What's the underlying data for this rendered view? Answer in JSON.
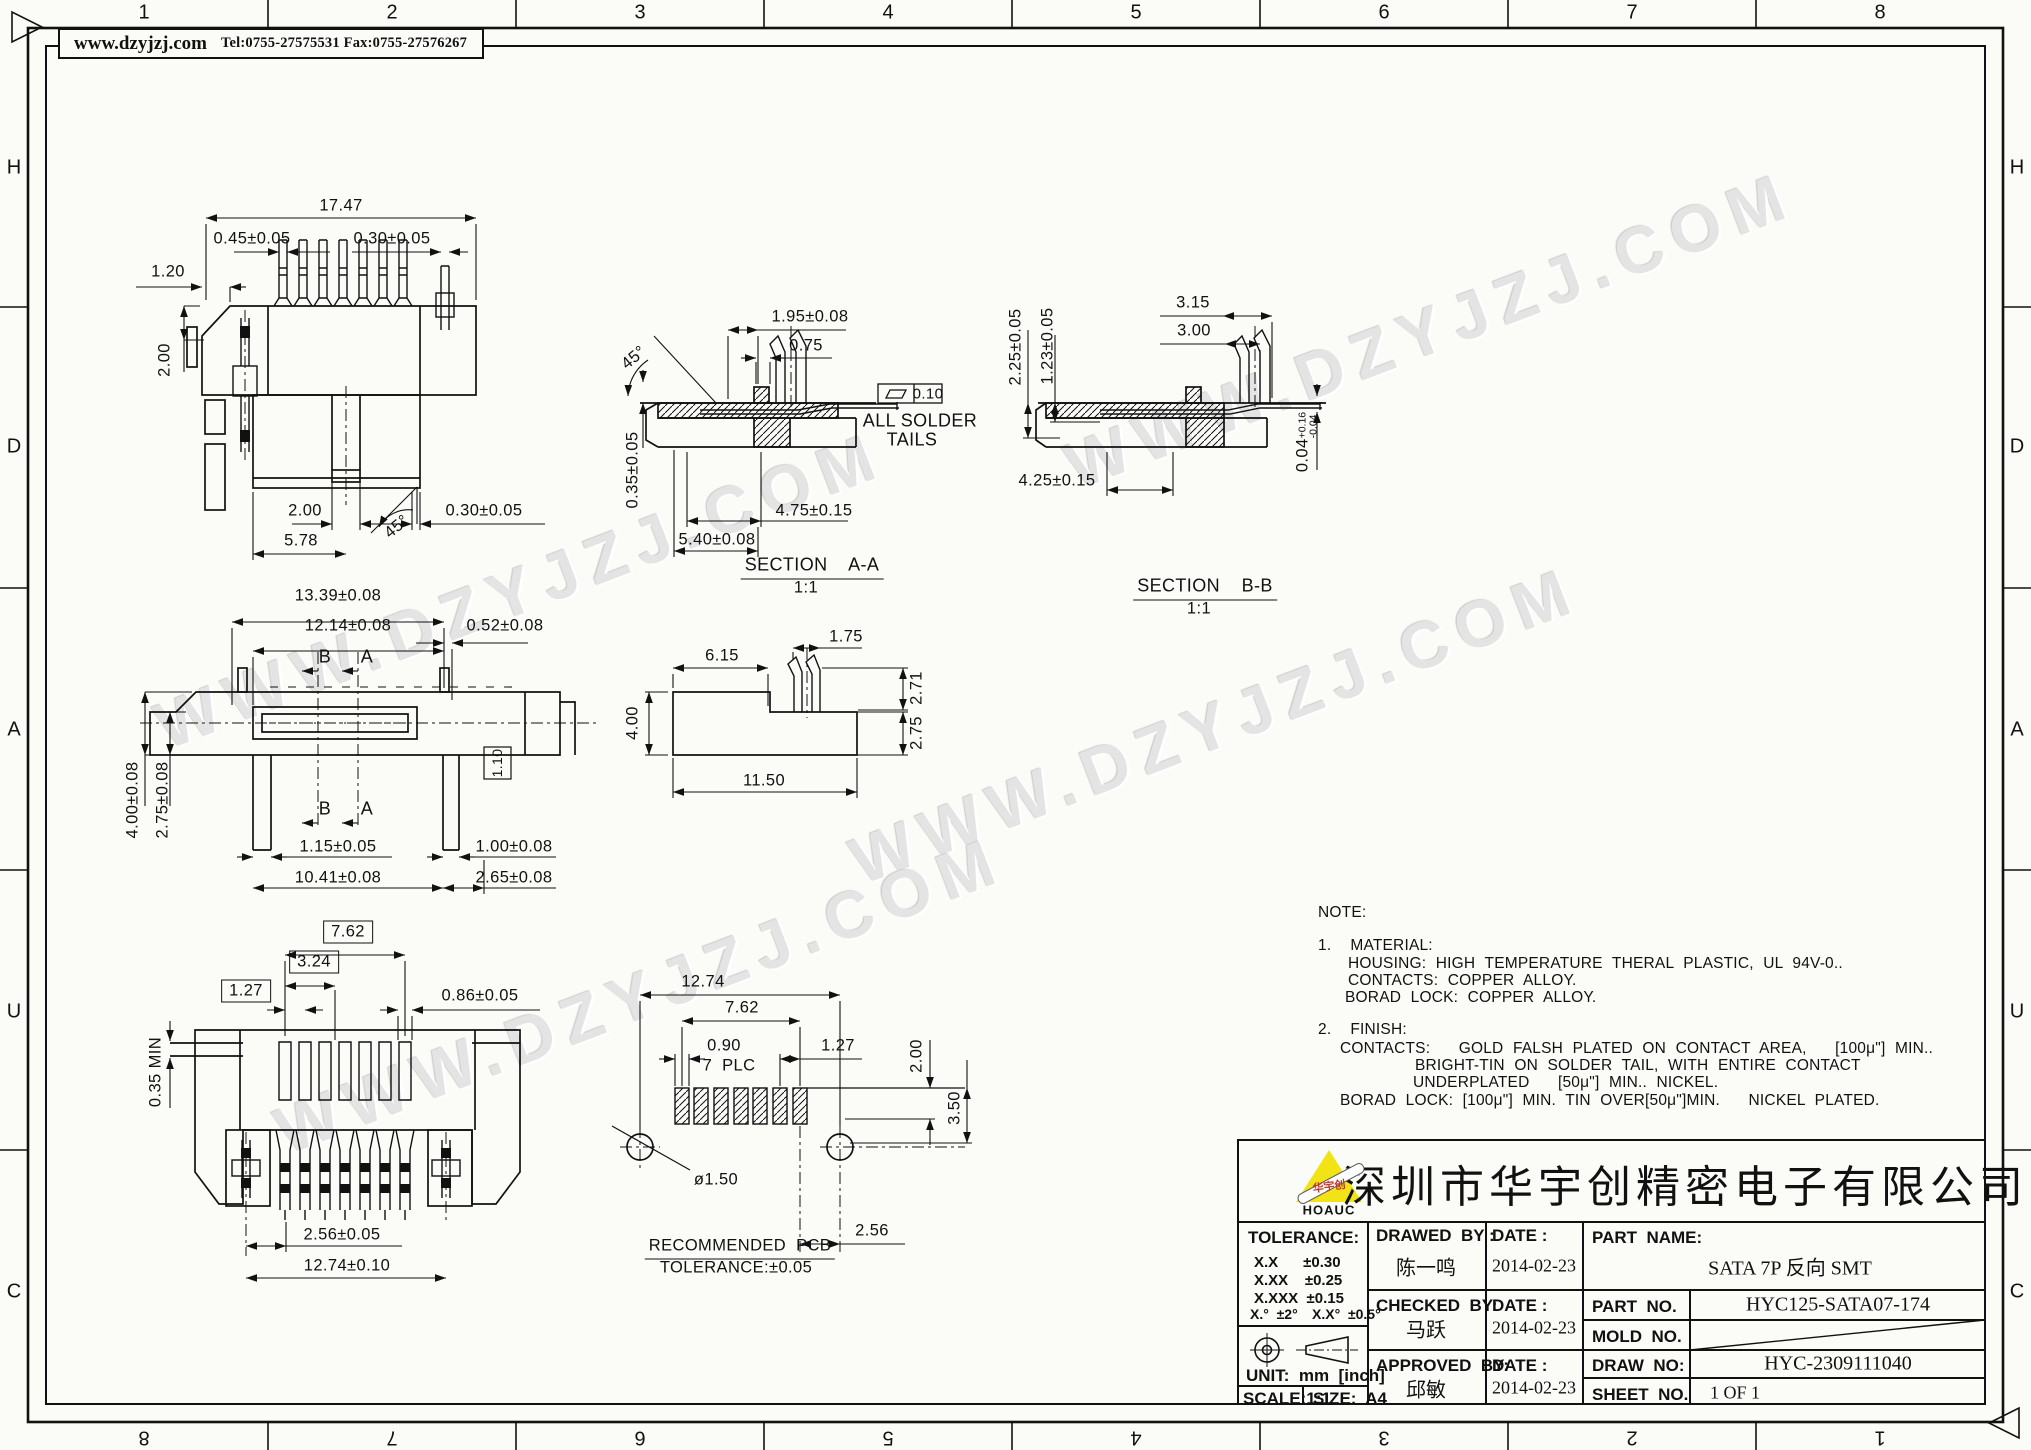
{
  "header": {
    "website": "www.dzyjzj.com",
    "contact": "Tel:0755-27575531  Fax:0755-27576267"
  },
  "watermark": {
    "text": "WWW.DZYJZJ.COM"
  },
  "border": {
    "top": [
      "1",
      "2",
      "3",
      "4",
      "5",
      "6",
      "7",
      "8"
    ],
    "bottom": [
      "8",
      "7",
      "6",
      "5",
      "4",
      "3",
      "2",
      "1"
    ],
    "left": [
      "H",
      "D",
      "A",
      "U",
      "C"
    ],
    "right": [
      "H",
      "D",
      "A",
      "U",
      "C"
    ]
  },
  "views": {
    "top_view": {
      "d_overall": "17.47",
      "d_pin_left": "0.45±0.05",
      "d_pin_right": "0.30±0.05",
      "d_edge": "1.20",
      "d_height": "2.00",
      "d_slot": "2.00",
      "d_base": "5.78",
      "d_tail": "0.30±0.05",
      "angle": "45°"
    },
    "front_view": {
      "d_w1": "13.39±0.08",
      "d_w2": "12.14±0.08",
      "d_w3": "0.52±0.08",
      "sec_b": "B",
      "sec_a": "A",
      "d_h1": "4.00±0.08",
      "d_h2": "2.75±0.08",
      "d_box": "1.10",
      "d_leg_l": "1.15±0.05",
      "d_leg_r": "1.00±0.08",
      "d_span": "10.41±0.08",
      "d_end": "2.65±0.08"
    },
    "bottom_view": {
      "d_b1": "7.62",
      "d_b2": "3.24",
      "d_b3": "1.27",
      "d_gap": "0.86±0.05",
      "d_min": "0.35 MIN",
      "d_p1": "2.56±0.05",
      "d_p2": "12.74±0.10"
    },
    "profile_view": {
      "d1": "6.15",
      "d2": "1.75",
      "d3": "2.71",
      "d4": "2.75",
      "d5": "4.00",
      "d6": "11.50"
    },
    "section_a": {
      "angle": "45°",
      "d1": "1.95±0.08",
      "d2": "0.75",
      "d3": "0.35±0.05",
      "flatness": "0.10",
      "note1": "ALL SOLDER",
      "note2": "TAILS",
      "d4": "4.75±0.15",
      "d5": "5.40±0.08",
      "title": "SECTION    A-A",
      "scale": "1:1"
    },
    "section_b": {
      "d1": "3.15",
      "d2": "3.00",
      "d3": "2.25±0.05",
      "d4": "1.23±0.05",
      "d5": "4.25±0.15",
      "d6": "0.04",
      "d6_sup": "+0.16",
      "d6_sub": "-0.04",
      "title": "SECTION    B-B",
      "scale": "1:1"
    },
    "pcb_view": {
      "d1": "12.74",
      "d2": "7.62",
      "d3": "0.90",
      "plc": "7  PLC",
      "d4": "1.27",
      "d5": "2.00",
      "d6": "3.50",
      "hole": "ø1.50",
      "d7": "2.56",
      "title": "RECOMMENDED  PCB",
      "tolerance": "TOLERANCE:±0.05"
    }
  },
  "notes": {
    "heading": "NOTE:",
    "lines": [
      "1.  MATERIAL:",
      "HOUSING: HIGH TEMPERATURE THERAL PLASTIC, UL 94V-0..",
      "CONTACTS: COPPER ALLOY.",
      "BORAD LOCK: COPPER ALLOY.",
      "2.  FINISH:",
      "CONTACTS:   GOLD FALSH PLATED ON CONTACT AREA,   [100μ\"] MIN..",
      "BRIGHT-TIN ON SOLDER TAIL, WITH ENTIRE CONTACT",
      "UNDERPLATED   [50μ\"] MIN.. NICKEL.",
      "BORAD LOCK: [100μ\"] MIN. TIN OVER[50μ\"]MIN.   NICKEL PLATED."
    ]
  },
  "titleblock": {
    "logo": {
      "brand": "华宇创",
      "sub": "HOAUC"
    },
    "company": "深圳市华宇创精密电子有限公司",
    "tolerance_label": "TOLERANCE:",
    "tol1": "X.X      ±0.30",
    "tol2": "X.XX    ±0.25",
    "tol3": "X.XXX  ±0.15",
    "tol4": "X.°  ±2°",
    "tol5": "X.X°  ±0.5°",
    "unit": "UNIT:  mm  [inch]",
    "scale": "SCALE:1:1",
    "size": "SIZE:  A4",
    "drawn": {
      "label": "DRAWED  BY :",
      "name": "陈一鸣",
      "date_label": "DATE :",
      "date": "2014-02-23"
    },
    "checked": {
      "label": "CHECKED  BY:",
      "name": "马跃",
      "date_label": "DATE :",
      "date": "2014-02-23"
    },
    "approved": {
      "label": "APPROVED  BY:",
      "name": "邱敏",
      "date_label": "DATE :",
      "date": "2014-02-23"
    },
    "part_name": {
      "label": "PART  NAME:",
      "value": "SATA 7P 反向 SMT"
    },
    "part_no": {
      "label": "PART  NO.",
      "value": "HYC125-SATA07-174"
    },
    "mold_no": {
      "label": "MOLD  NO.",
      "value": ""
    },
    "draw_no": {
      "label": "DRAW  NO:",
      "value": "HYC-2309111040"
    },
    "sheet_no": {
      "label": "SHEET  NO.",
      "value": "1 OF 1"
    }
  }
}
